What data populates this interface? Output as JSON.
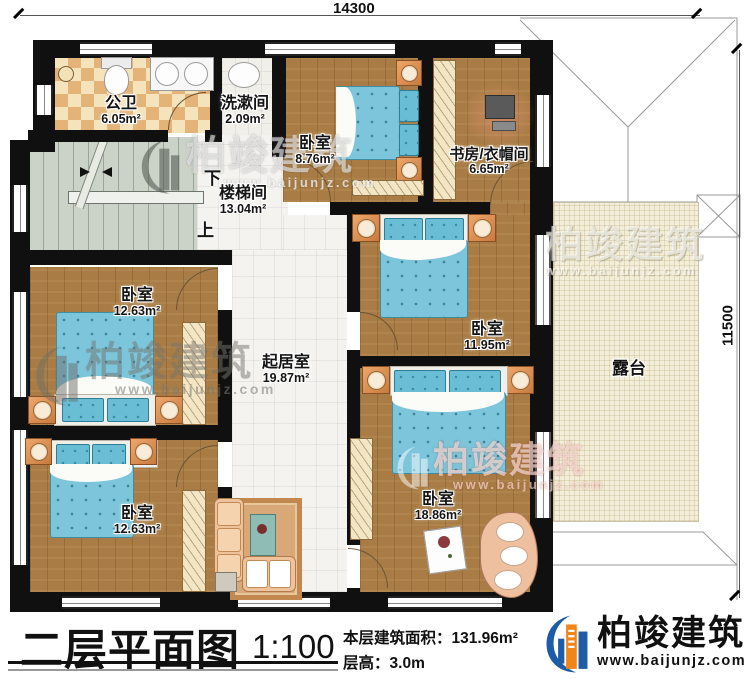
{
  "dimensions": {
    "top": "14300",
    "right": "11500"
  },
  "rooms": {
    "bath": {
      "name": "公卫",
      "area": "6.05m²"
    },
    "wash": {
      "name": "洗漱间",
      "area": "2.09m²"
    },
    "stair": {
      "name": "楼梯间",
      "area": "13.04m²",
      "down_label": "下",
      "up_label": "上"
    },
    "bed_top": {
      "name": "卧室",
      "area": "8.76m²"
    },
    "study": {
      "name": "书房/衣帽间",
      "area": "6.65m²"
    },
    "bed_midleft": {
      "name": "卧室",
      "area": "12.63m²"
    },
    "living": {
      "name": "起居室",
      "area": "19.87m²"
    },
    "bed_midright": {
      "name": "卧室",
      "area": "11.95m²"
    },
    "bed_botleft": {
      "name": "卧室",
      "area": "12.63m²"
    },
    "bed_botright": {
      "name": "卧室",
      "area": "18.86m²"
    },
    "terrace": {
      "name": "露台"
    }
  },
  "watermark": {
    "brand": "柏竣建筑",
    "url": "www.baijunjz.com"
  },
  "footer": {
    "plan_title": "二层平面图",
    "scale": "1:100",
    "area_label": "本层建筑面积：",
    "area_value": "131.96m²",
    "height_label": "层高：",
    "height_value": "3.0m",
    "brand": "柏竣建筑",
    "brand_url": "www.baijunjz.com"
  },
  "colors": {
    "brand_blue": "#1d5ca6",
    "brand_orange": "#f08519",
    "wall": "#101010",
    "wood": "#a87c44",
    "mattress": "#7cc5da"
  }
}
